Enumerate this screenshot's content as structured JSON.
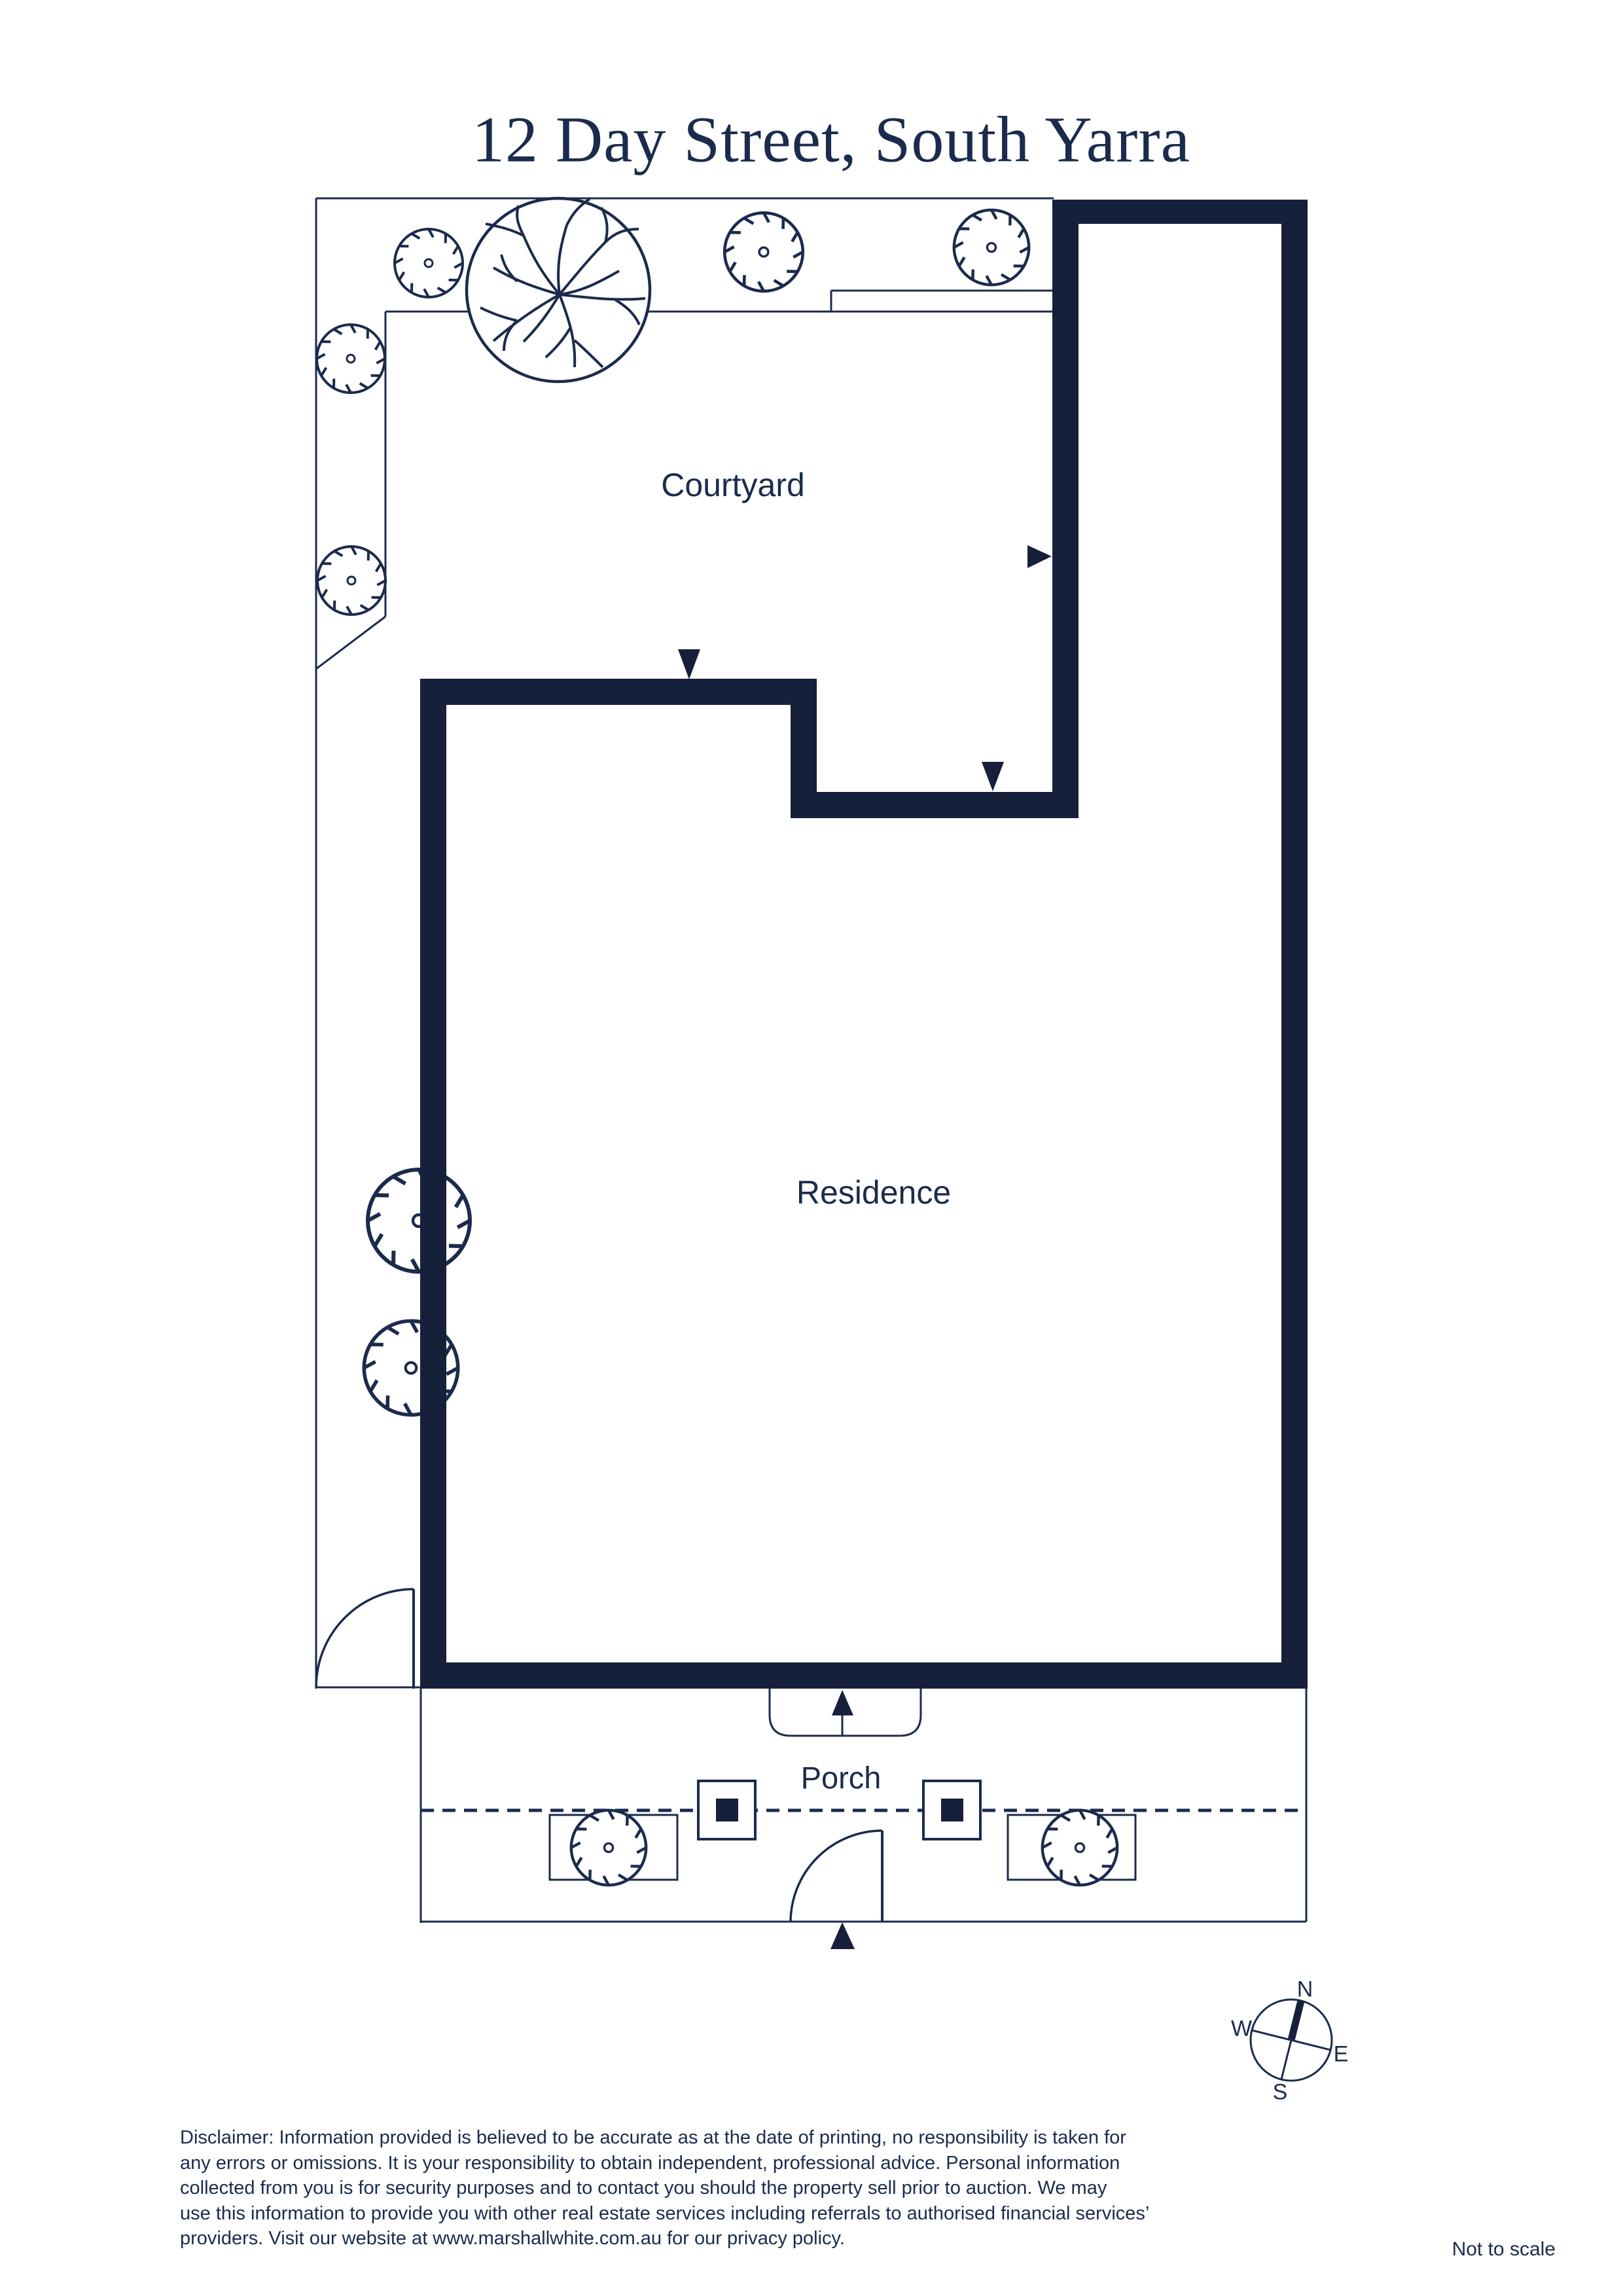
{
  "page": {
    "title": "12 Day Street, South Yarra",
    "not_to_scale": "Not to scale"
  },
  "plan": {
    "labels": {
      "courtyard": "Courtyard",
      "residence": "Residence",
      "porch": "Porch"
    },
    "icons": {
      "large_tree": "tree-canopy-icon",
      "shrub": "shrub-icon",
      "door_arrows": "entry-arrow-icon",
      "compass": "compass-rose-icon"
    }
  },
  "compass": {
    "n": "N",
    "w": "W",
    "e": "E",
    "s": "S"
  },
  "disclaimer": {
    "lines": [
      "Disclaimer: Information provided is believed to be accurate as at the date of printing, no responsibility is taken for",
      "any errors or omissions. It is your responsibility to obtain independent, professional advice. Personal information",
      "collected from you is for security purposes and to contact you should the property sell prior to auction. We may",
      "use this information to provide you with other real estate services including referrals to authorised financial services’",
      "providers. Visit our website at www.marshallwhite.com.au for our privacy policy."
    ]
  },
  "colors": {
    "ink": "#1b2b4d",
    "wall": "#16203a",
    "background": "#ffffff"
  }
}
